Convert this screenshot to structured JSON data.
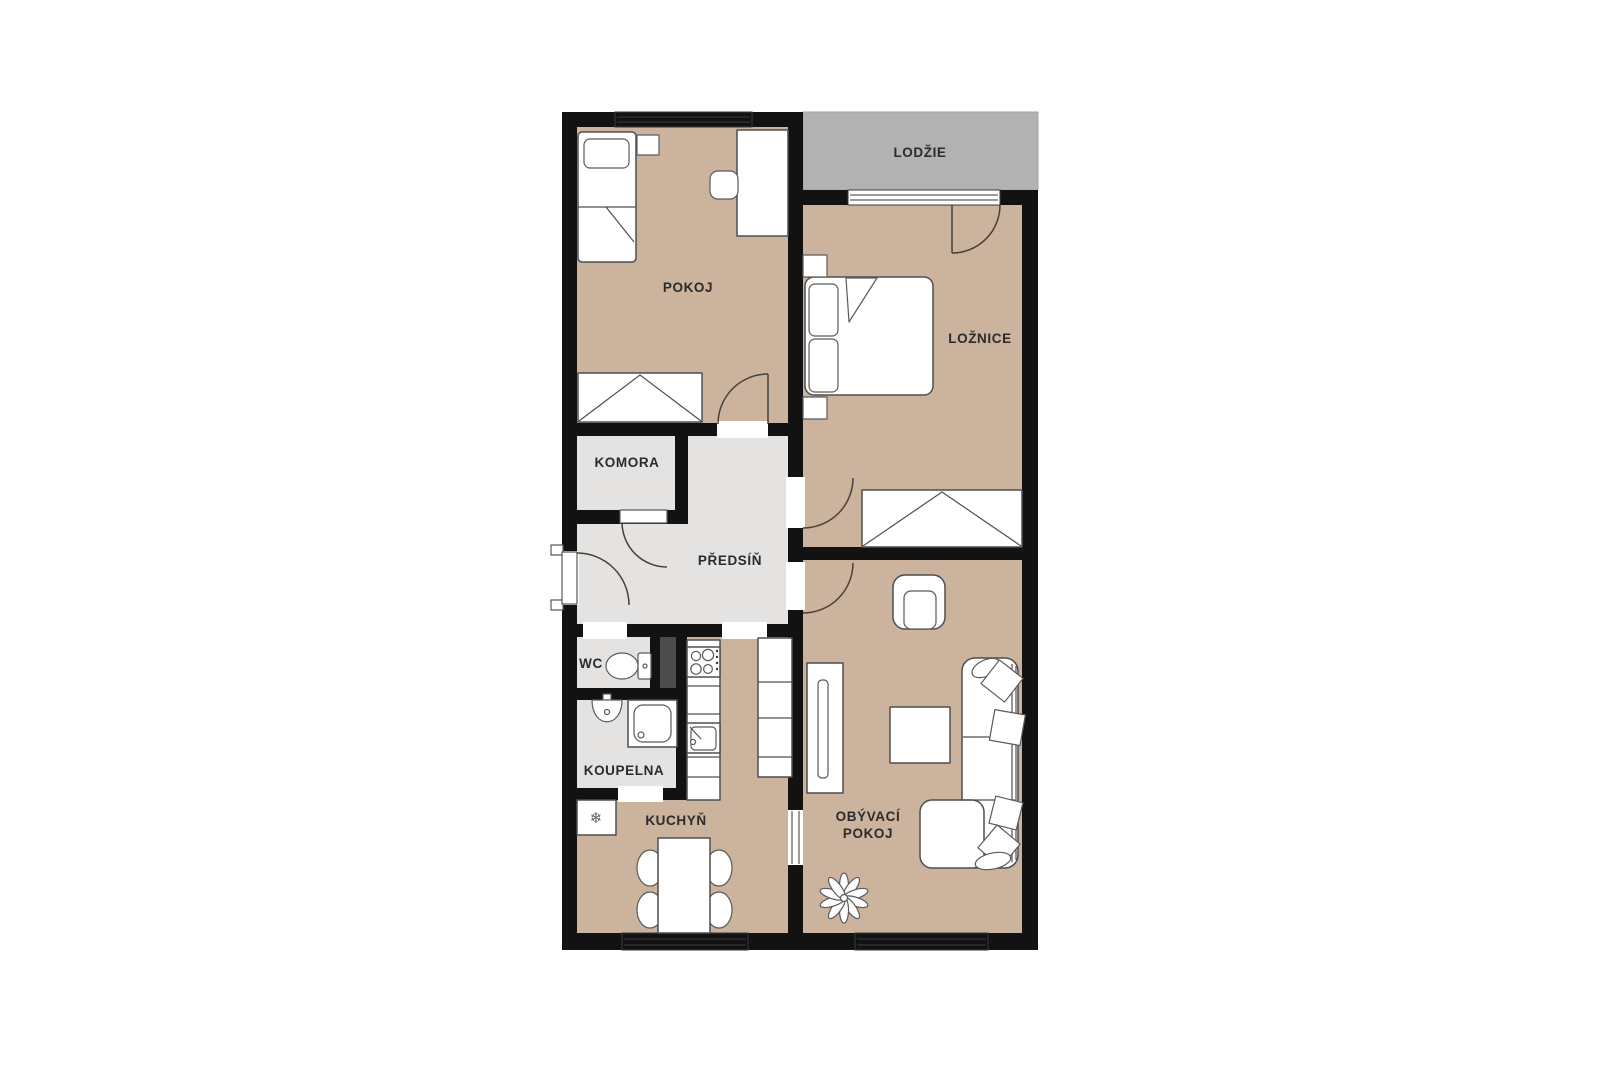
{
  "rooms": {
    "lodzie": "LODŽIE",
    "pokoj": "POKOJ",
    "loznice": "LOŽNICE",
    "komora": "KOMORA",
    "predsin": "PŘEDSÍŇ",
    "wc": "WC",
    "koupelna": "KOUPELNA",
    "kuchyn": "KUCHYŇ",
    "obyvaci_line1": "OBÝVACÍ",
    "obyvaci_line2": "POKOJ"
  },
  "icons": {
    "fridge_snowflake": "❄"
  },
  "colors": {
    "background": "#ffffff",
    "wall": "#121212",
    "floor_room_tan": "#cbb39d",
    "floor_hall_gray": "#e4e3e1",
    "loggia_gray": "#b2b2b2",
    "shaft_gray": "#4c4c4c",
    "furniture_outline": "#4f4f4f",
    "label_text": "#2b2b2b"
  }
}
